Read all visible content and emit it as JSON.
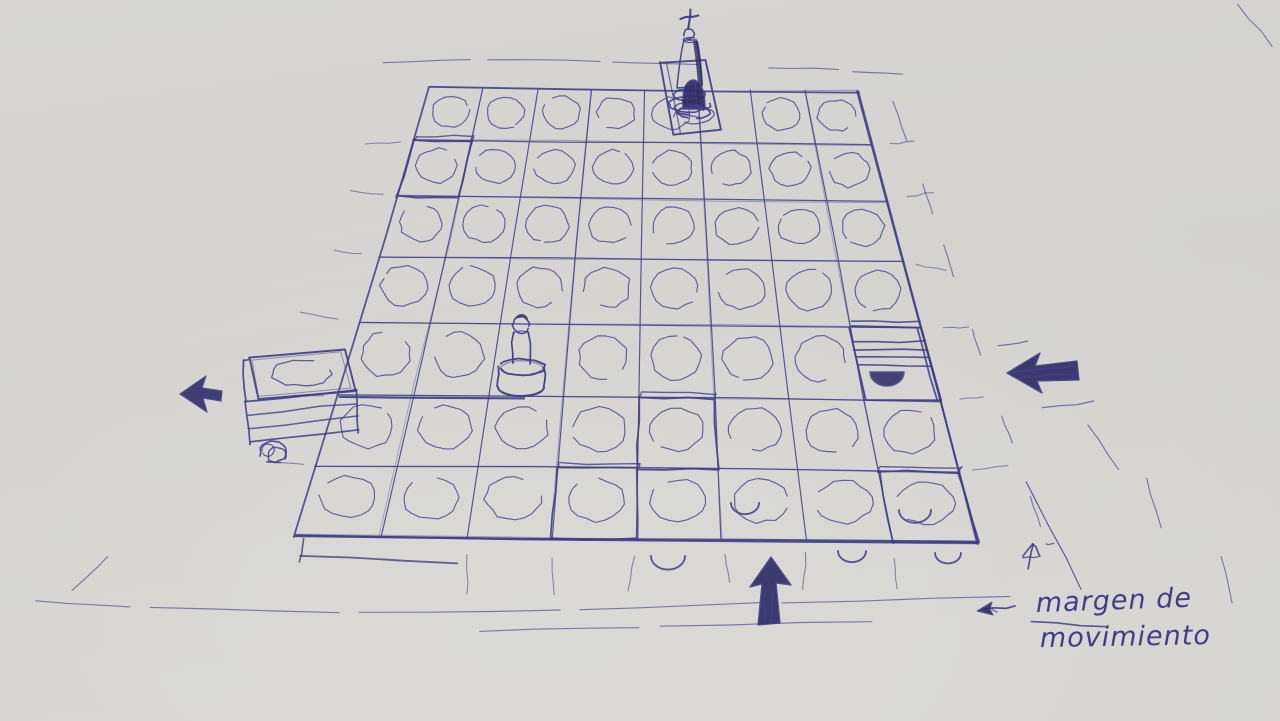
{
  "scene": {
    "type": "photo of a hand-drawn ballpoint pen sketch on paper",
    "subject": "perspective game board grid with pieces, movement arrows and a dashed movement-margin band",
    "paper_color": "#d3d2cf",
    "paper_light": "#dcdbd7",
    "paper_dark": "#cbcac7",
    "ink_color": "#413e86",
    "ink_heavy": "#2c2963"
  },
  "board": {
    "rows": 7,
    "columns": 8,
    "cell_marker": "hand-drawn open circle in each tile",
    "description": "flat perspective grid drawn in pen; a dashed band outside every edge marks the movement margin"
  },
  "pieces": [
    {
      "id": "king",
      "description": "king piece with cross finial on a raised tile above the top edge"
    },
    {
      "id": "dark-pawn",
      "description": "small ink-filled pawn on row 1 below the king"
    },
    {
      "id": "round-pawn",
      "description": "round-headed pawn on cylindrical base near board centre, row 5"
    }
  ],
  "blocks": [
    {
      "id": "left-edge-block",
      "description": "raised block tile protruding from the left edge with scribbled wheel"
    },
    {
      "id": "right-hatched-block",
      "description": "hatched raised tile on right edge with dark arch shadow"
    }
  ],
  "arrows": [
    {
      "id": "left-edge-arrow",
      "direction": "left",
      "style": "filled scribble"
    },
    {
      "id": "right-edge-arrow",
      "direction": "left",
      "style": "filled scribble"
    },
    {
      "id": "bottom-up-arrow",
      "direction": "up",
      "style": "filled scribble"
    },
    {
      "id": "small-up-arrow",
      "direction": "up",
      "style": "thin line"
    },
    {
      "id": "label-arrow",
      "direction": "left",
      "style": "thin line"
    }
  ],
  "annotation": {
    "line1": "margen de",
    "line2": "movimiento"
  }
}
